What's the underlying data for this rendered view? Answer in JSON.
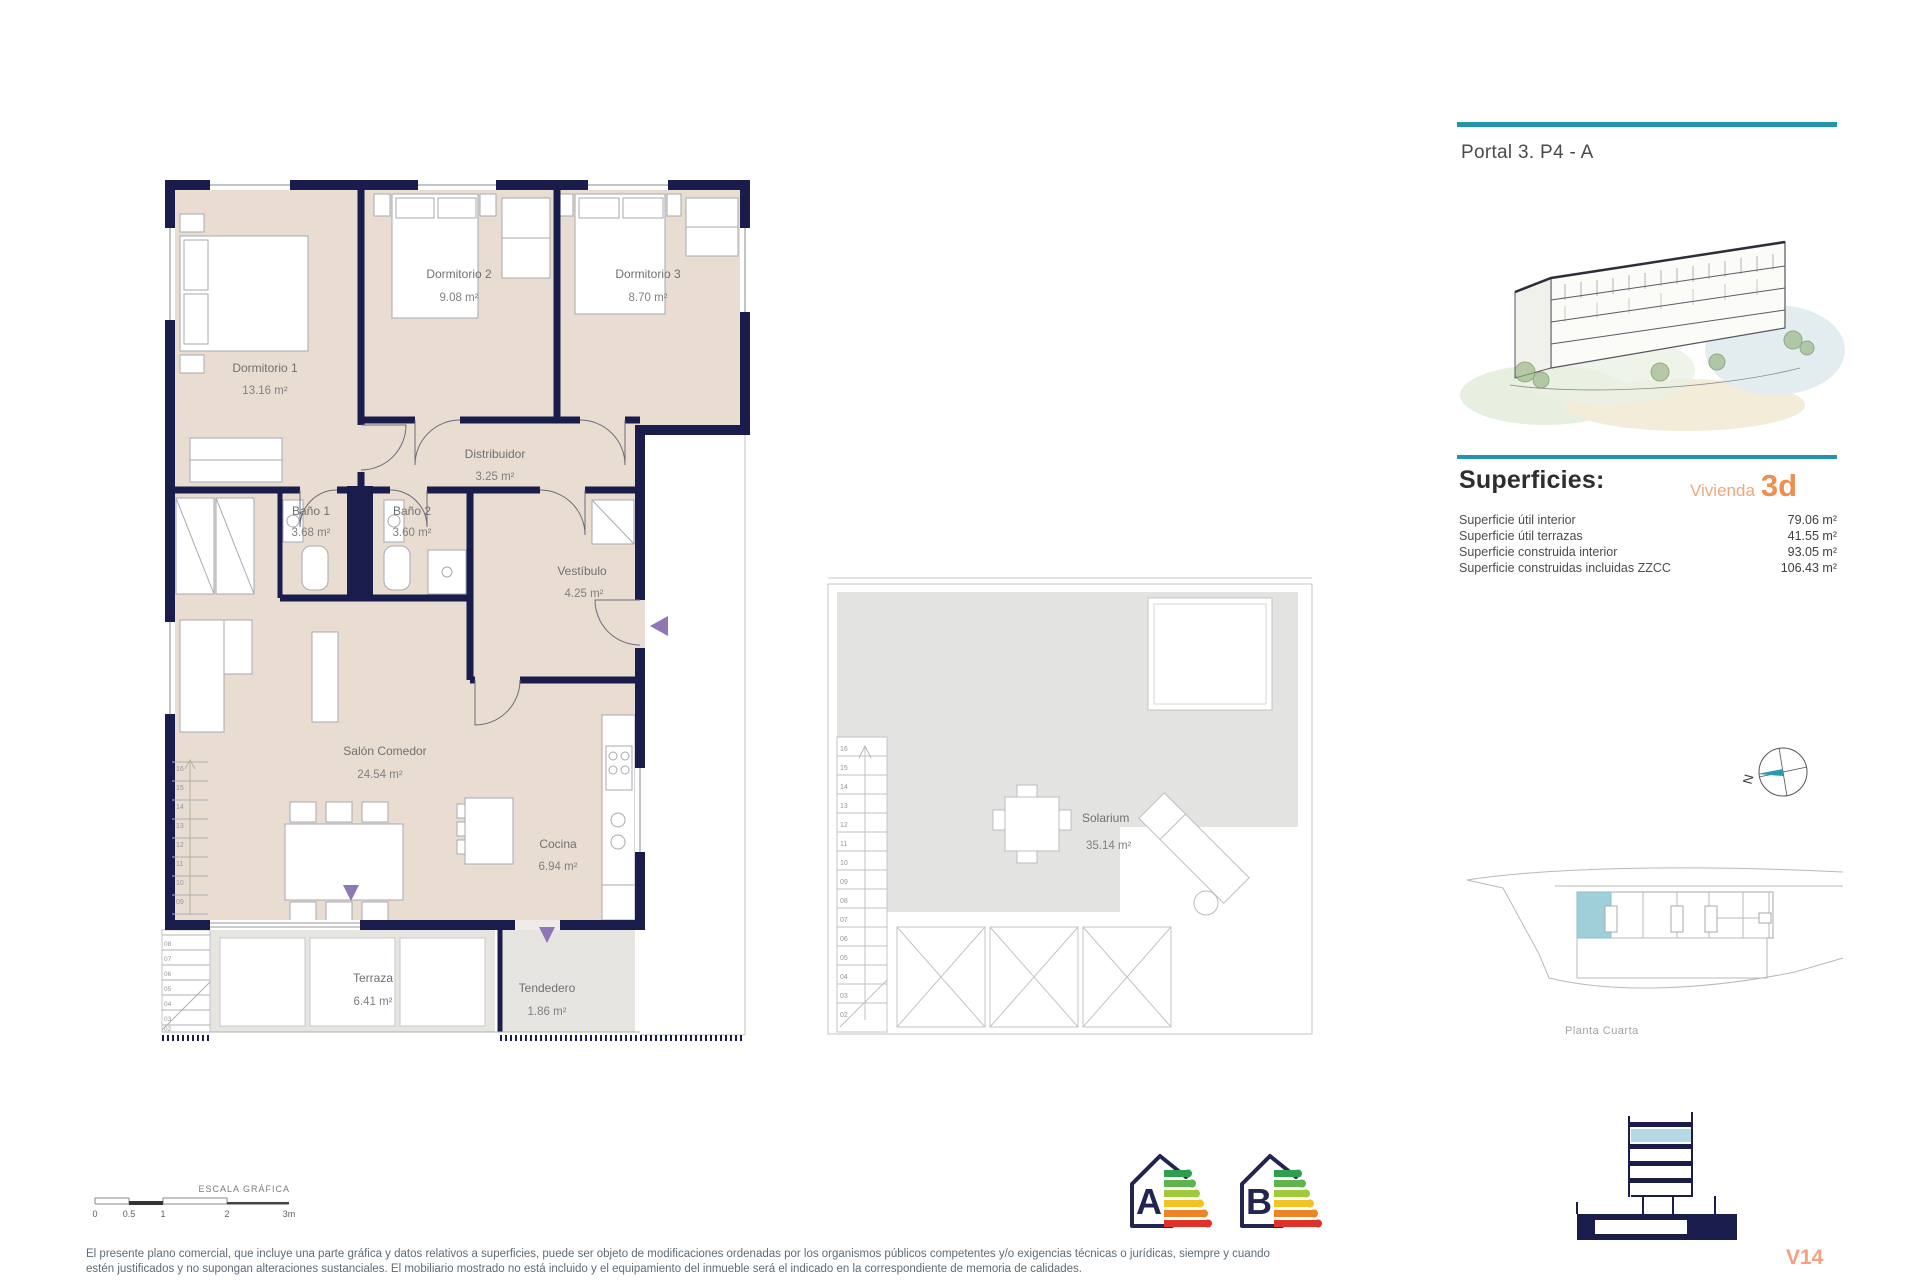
{
  "colors": {
    "accent_teal": "#2196a8",
    "accent_orange": "#ee8f4f",
    "wall_navy": "#1a1d4c",
    "floor_beige": "#e9ddd1",
    "entry_purple": "#8f76b5"
  },
  "header": {
    "portal_title": "Portal 3. P4 - A"
  },
  "superficies": {
    "heading": "Superficies:",
    "vivienda_label": "Vivienda",
    "vivienda_code": "3d",
    "rows": [
      {
        "label": "Superficie útil interior",
        "value": "79.06 m²"
      },
      {
        "label": "Superficie útil terrazas",
        "value": "41.55 m²"
      },
      {
        "label": "Superficie construida interior",
        "value": "93.05 m²"
      },
      {
        "label": "Superficie construidas incluidas ZZCC",
        "value": "106.43 m²"
      }
    ]
  },
  "floor_plan": {
    "rooms": [
      {
        "name": "Dormitorio 1",
        "area": "13.16 m²"
      },
      {
        "name": "Dormitorio 2",
        "area": "9.08 m²"
      },
      {
        "name": "Dormitorio 3",
        "area": "8.70 m²"
      },
      {
        "name": "Distribuidor",
        "area": "3.25 m²"
      },
      {
        "name": "Baño 1",
        "area": "3.68 m²"
      },
      {
        "name": "Baño 2",
        "area": "3.60 m²"
      },
      {
        "name": "Vestíbulo",
        "area": "4.25 m²"
      },
      {
        "name": "Salón Comedor",
        "area": "24.54 m²"
      },
      {
        "name": "Cocina",
        "area": "6.94 m²"
      },
      {
        "name": "Terraza",
        "area": "6.41 m²"
      },
      {
        "name": "Tendedero",
        "area": "1.86 m²"
      }
    ]
  },
  "solarium": {
    "name": "Solarium",
    "area": "35.14 m²",
    "stairs": [
      "16",
      "15",
      "14",
      "13",
      "12",
      "11",
      "10",
      "09",
      "08",
      "07",
      "06",
      "05",
      "04",
      "03",
      "02"
    ]
  },
  "key_plan": {
    "caption": "Planta Cuarta"
  },
  "compass": {
    "label": "N"
  },
  "scale_bar": {
    "title": "ESCALA GRÁFICA",
    "ticks": [
      "0",
      "0.5",
      "1",
      "2",
      "3m"
    ]
  },
  "energy": {
    "labels": [
      "A",
      "B"
    ]
  },
  "footer": {
    "disclaimer_line1": "El presente plano comercial, que incluye una parte gráfica y datos relativos a superficies, puede ser objeto de modificaciones ordenadas por los organismos públicos competentes y/o exigencias técnicas o jurídicas, siempre y cuando",
    "disclaimer_line2": "estén justificados y no supongan alteraciones sustanciales. El mobiliario mostrado no está incluido y el equipamiento del inmueble será el indicado en la correspondiente de memoria de calidades.",
    "version": "V14"
  }
}
